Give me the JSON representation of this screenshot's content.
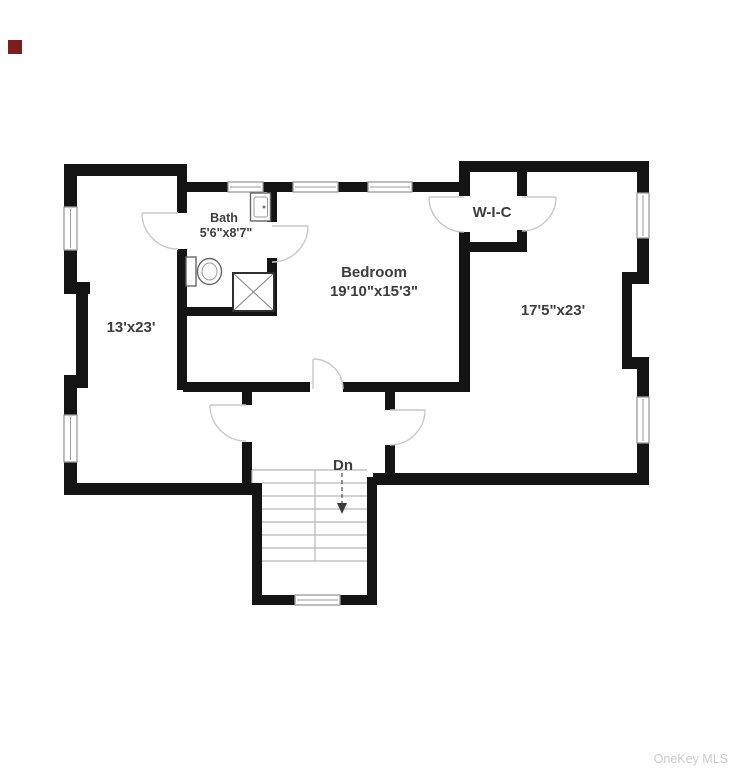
{
  "colors": {
    "bg": "#ffffff",
    "wall": "#141414",
    "label": "#3d3d3d",
    "door": "#c9c9c9",
    "window": "#9a9a9a",
    "stair": "#b7b7b7",
    "fixture": "#666666",
    "watermark": "#cccccc",
    "marker": "#7a1f1f"
  },
  "rooms": {
    "left": {
      "dims": "13'x23'"
    },
    "bath": {
      "name": "Bath",
      "dims": "5'6\"x8'7\""
    },
    "bedroom": {
      "name": "Bedroom",
      "dims": "19'10\"x15'3\""
    },
    "wic": {
      "name": "W-I-C"
    },
    "right": {
      "dims": "17'5\"x23'"
    }
  },
  "stairs": {
    "label": "Dn"
  },
  "watermark": {
    "text": "OneKey MLS"
  }
}
